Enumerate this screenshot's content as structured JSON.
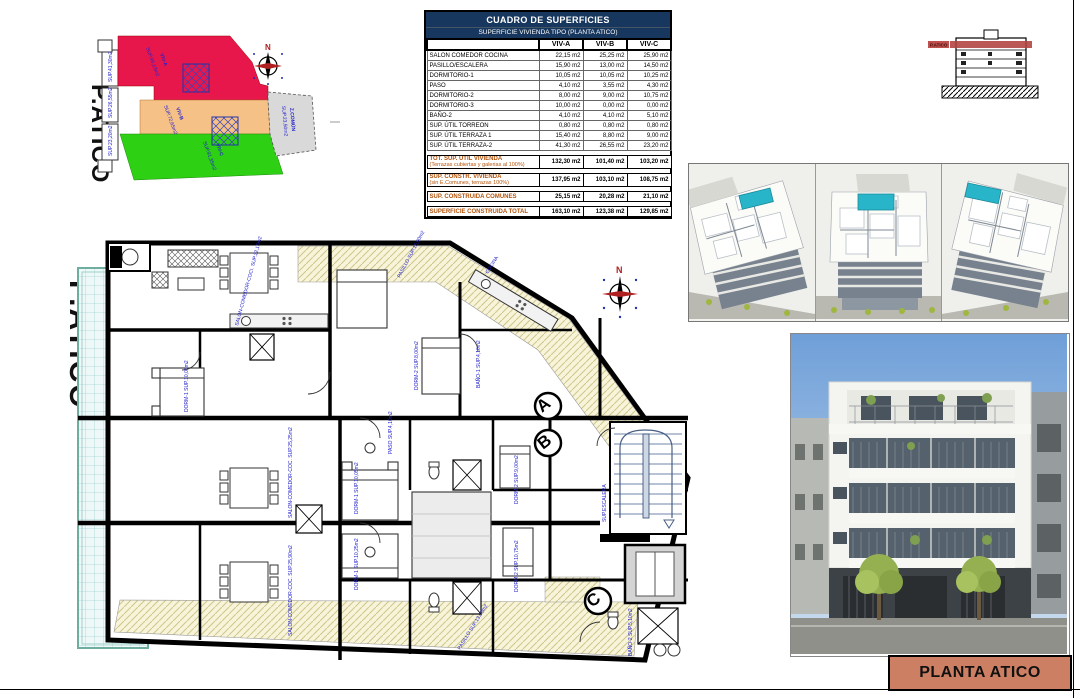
{
  "sheet": {
    "title_block": "PLANTA ATICO"
  },
  "site_key": {
    "title": "P.ATICO",
    "north_label": "N",
    "zones": {
      "viv_a": {
        "name": "VIV-A",
        "sup": "SUP.96,10m2",
        "color": "#e8174b"
      },
      "viv_b": {
        "name": "VIV-B",
        "sup": "SUP.72,65m2",
        "color": "#f6c186"
      },
      "viv_c": {
        "name": "VIV-C",
        "sup": "SUP.91,35m2",
        "color": "#2ed013"
      },
      "comun": {
        "name": "Z.COMÚN",
        "sup": "SUP.23,50m2",
        "color": "#d9d9d9"
      }
    },
    "edge_labels": [
      "SUP.41,30m2",
      "SUP.26,55m2",
      "SUP.23,20m2"
    ]
  },
  "surface_table": {
    "title": "CUADRO DE SUPERFICIES",
    "subtitle": "SUPERFICIE VIVIENDA TIPO  (PLANTA ATICO)",
    "columns": [
      "VIV-A",
      "VIV-B",
      "VIV-C"
    ],
    "rows": [
      {
        "label": "SALON COMEDOR COCINA",
        "a": "22,15 m2",
        "b": "25,25 m2",
        "c": "25,90 m2"
      },
      {
        "label": "PASILLO/ESCALERA",
        "a": "15,90 m2",
        "b": "13,00 m2",
        "c": "14,50 m2"
      },
      {
        "label": "DORMITORIO-1",
        "a": "10,05 m2",
        "b": "10,05 m2",
        "c": "10,25 m2"
      },
      {
        "label": "PASO",
        "a": "4,10 m2",
        "b": "3,55 m2",
        "c": "4,30 m2"
      },
      {
        "label": "DORMITORIO-2",
        "a": "8,00 m2",
        "b": "9,00 m2",
        "c": "10,75 m2"
      },
      {
        "label": "DORMITORIO-3",
        "a": "10,00 m2",
        "b": "0,00 m2",
        "c": "0,00 m2"
      },
      {
        "label": "BAÑO-2",
        "a": "4,10 m2",
        "b": "4,10 m2",
        "c": "5,10 m2"
      },
      {
        "label": "SUP. ÚTIL TORREON",
        "a": "0,80 m2",
        "b": "0,80 m2",
        "c": "0,80 m2"
      },
      {
        "label": "SUP. ÚTIL TERRAZA 1",
        "a": "15,40 m2",
        "b": "8,80 m2",
        "c": "9,00 m2"
      },
      {
        "label": "SUP. ÚTIL TERRAZA-2",
        "a": "41,30 m2",
        "b": "26,55 m2",
        "c": "23,20 m2"
      }
    ],
    "totals": [
      {
        "label": "TOT. SUP. UTIL VIVIENDA",
        "sublabel": "(Terrazas cubiertas y galerias al 100%)",
        "a": "132,30 m2",
        "b": "101,40 m2",
        "c": "103,20 m2"
      },
      {
        "label": "SUP. CONSTR. VIVIENDA",
        "sublabel": "(sin E.Comunes, terrazas 100%)",
        "a": "137,95 m2",
        "b": "103,10 m2",
        "c": "108,75 m2"
      },
      {
        "label": "SUP. CONSTRUIDA COMUNES",
        "sublabel": "",
        "a": "25,15 m2",
        "b": "20,28 m2",
        "c": "21,10 m2"
      },
      {
        "label": "SUPERFICIE CONSTRUIDA TOTAL",
        "sublabel": "",
        "a": "163,10 m2",
        "b": "123,38 m2",
        "c": "129,85 m2"
      }
    ]
  },
  "section_thumb": {
    "band_label": "P.ATICO"
  },
  "plan": {
    "title": "P.ATICO",
    "north_label": "N",
    "markers": [
      "A",
      "B",
      "C"
    ],
    "labels": {
      "terraza_a": "TERRAZA SUP.41,30m2",
      "terraza_b": "TERRAZA SUP.26,55m2",
      "terraza_c": "TERRAZA SUP.23,20m2",
      "pasillo_top": "PASILLO SUP.15,90m2",
      "salon_a": "SALON-COMEDOR-COCI. SUP.22,15m2",
      "salon_b": "SALON-COMEDOR-COC. SUP.25,25m2",
      "salon_c": "SALON-COMEDOR-COC. SUP.25,90m2",
      "dorm1_a": "DORM-1 SUP.10,05m2",
      "dorm1_b": "DORM-1 SUP.10,05m2",
      "dorm1_c": "DORM-1 SUP.10,25m2",
      "dorm2_top": "DORM-2 SUP.8,00m2",
      "dorm2_r1": "DORM-2 SUP.9,00m2",
      "dorm2_r2": "DORM-2 SUP.10,75m2",
      "bano1": "BAÑO-1 SUP.4,10m2",
      "bano2": "BAÑO-2 SUP.5,10m2",
      "paso": "PASO SUP.4,10m2",
      "cocina": "COCINA",
      "escalera": "SUP.ESCALERA",
      "pasillo_bottom": "PASILLO SUP.13,00m2"
    }
  }
}
